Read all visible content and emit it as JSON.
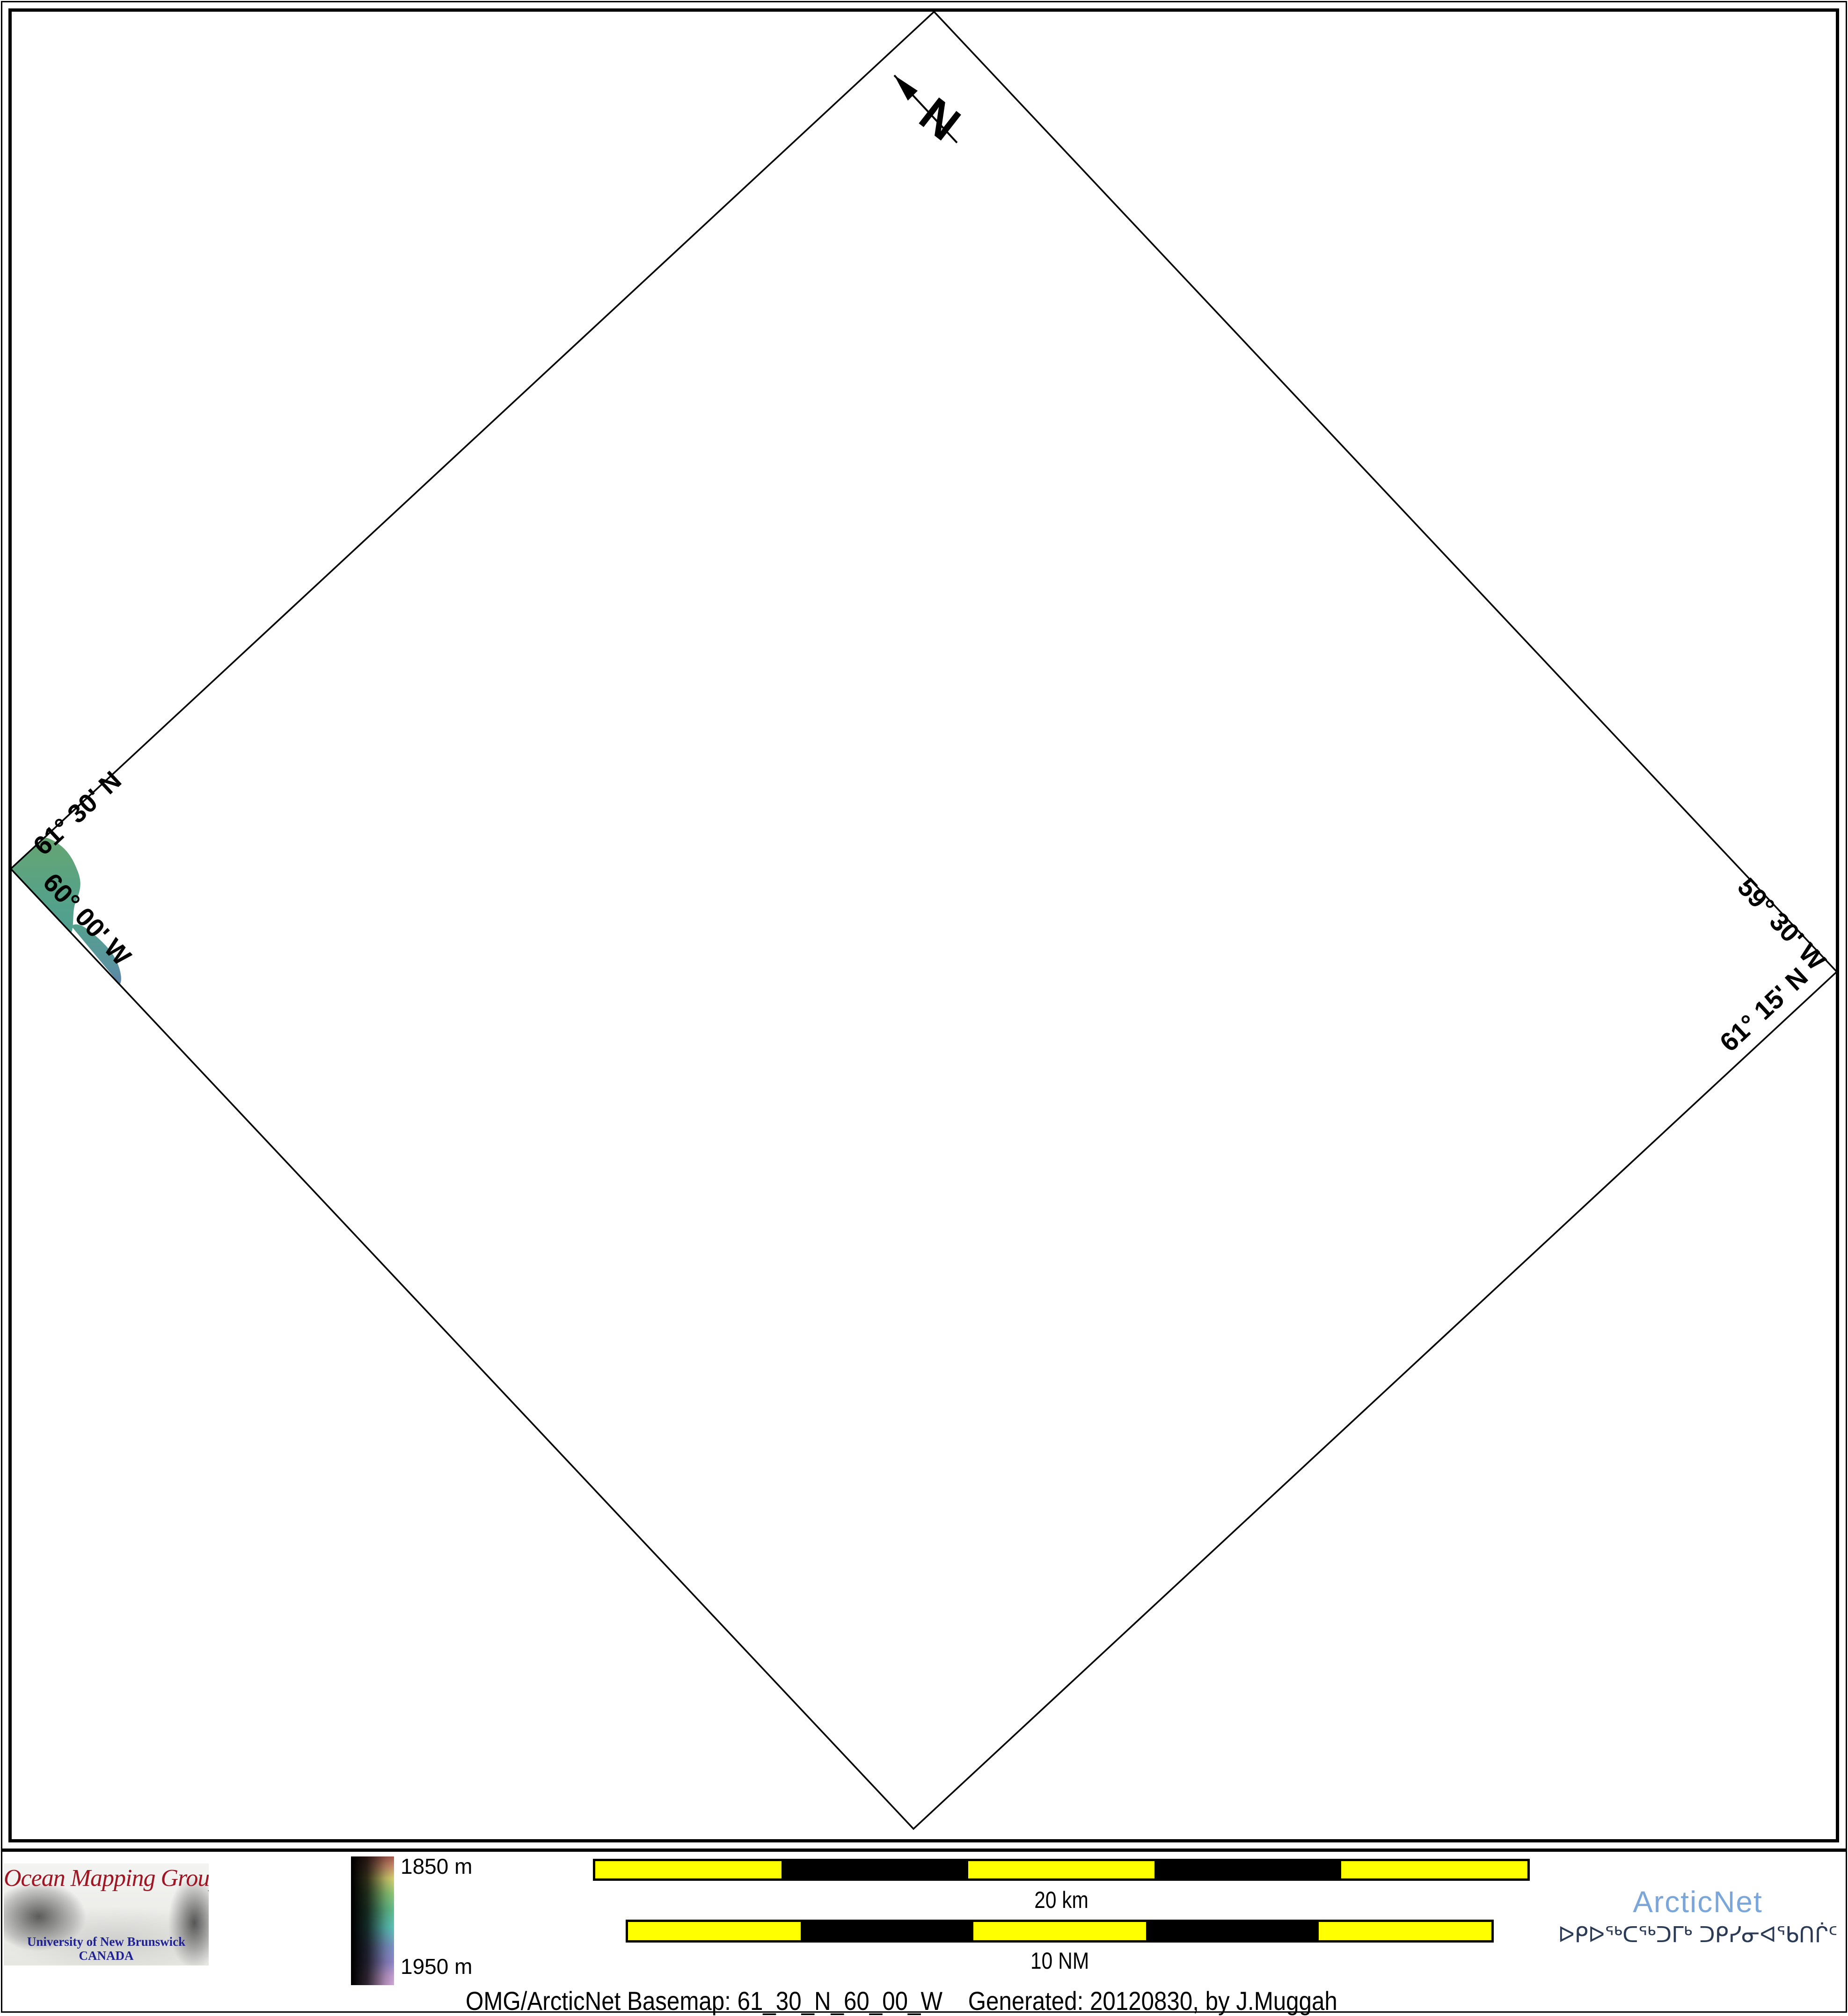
{
  "map": {
    "north_label": "N",
    "corner_labels": {
      "upper_left": "61° 30' N",
      "lower_left": "60° 00' W",
      "upper_right": "59° 30' W",
      "lower_right": "61° 15' N"
    }
  },
  "footer": {
    "logo": {
      "title": "Ocean Mapping Group",
      "institution": "University of New Brunswick",
      "country": "CANADA"
    },
    "colorbar": {
      "top": "1850 m",
      "bottom": "1950 m"
    },
    "scalebar_km": {
      "label": "20 km",
      "segments": 5
    },
    "scalebar_nm": {
      "label": "10 NM",
      "segments": 5
    },
    "arcticnet": {
      "name": "ArcticNet",
      "inuktitut": "ᐅᑭᐅᖅᑕᖅᑐᒥᒃ ᑐᑭᓯᓂᐊᖃᑎᒌᑦ"
    },
    "caption": "OMG/ArcticNet Basemap: 61_30_N_60_00_W    Generated: 20120830, by J.Muggah"
  },
  "colors": {
    "scalebar_yellow": "#ffff00",
    "arcticnet_blue": "#7aa6d9",
    "inuktitut_navy": "#2c3b55",
    "logo_red": "#a01523",
    "logo_navy": "#1f2294",
    "bathymetry_green": "#66a571",
    "bathymetry_teal": "#4f9f92",
    "bathymetry_blue": "#5b7fa6"
  }
}
